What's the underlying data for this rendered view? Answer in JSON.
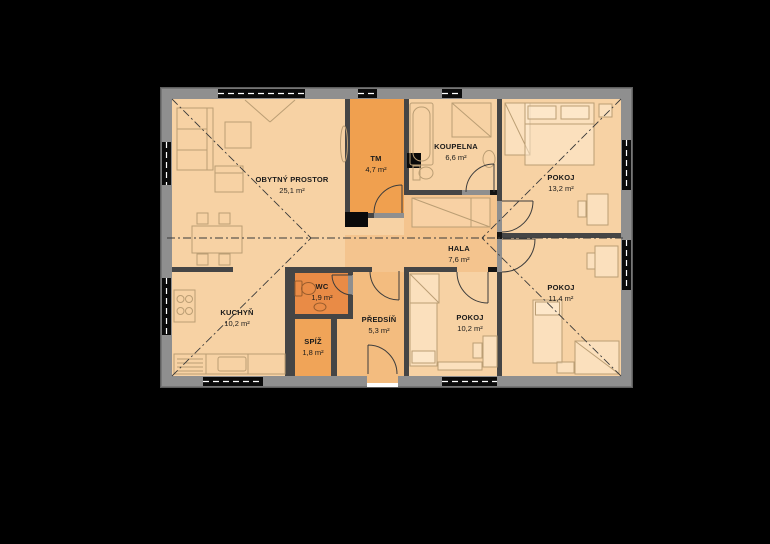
{
  "plan": {
    "rooms": [
      {
        "id": "obytny-prostor",
        "name": "OBYTNÝ PROSTOR",
        "area": "25,1 m²"
      },
      {
        "id": "tm",
        "name": "TM",
        "area": "4,7 m²"
      },
      {
        "id": "koupelna",
        "name": "KOUPELNA",
        "area": "6,6 m²"
      },
      {
        "id": "pokoj-13",
        "name": "POKOJ",
        "area": "13,2 m²"
      },
      {
        "id": "hala",
        "name": "HALA",
        "area": "7,6 m²"
      },
      {
        "id": "pokoj-11",
        "name": "POKOJ",
        "area": "11,4 m²"
      },
      {
        "id": "kuchyn",
        "name": "KUCHYŇ",
        "area": "10,2 m²"
      },
      {
        "id": "wc",
        "name": "WC",
        "area": "1,9 m²"
      },
      {
        "id": "spiz",
        "name": "SPÍŽ",
        "area": "1,8 m²"
      },
      {
        "id": "predsin",
        "name": "PŘEDSÍŇ",
        "area": "5,3 m²"
      },
      {
        "id": "pokoj-10",
        "name": "POKOJ",
        "area": "10,2 m²"
      }
    ],
    "colors": {
      "background": "#000000",
      "outer_wall": "#8f8f8f",
      "inner_wall": "#454545",
      "room_standard": "#f7d2a4",
      "room_hala": "#f4c48e",
      "room_predsin": "#f3bc7f",
      "room_tm": "#f0a04f",
      "room_spiz": "#f0a458",
      "room_wc": "#e98b46",
      "window": "#0b0b0b"
    }
  }
}
